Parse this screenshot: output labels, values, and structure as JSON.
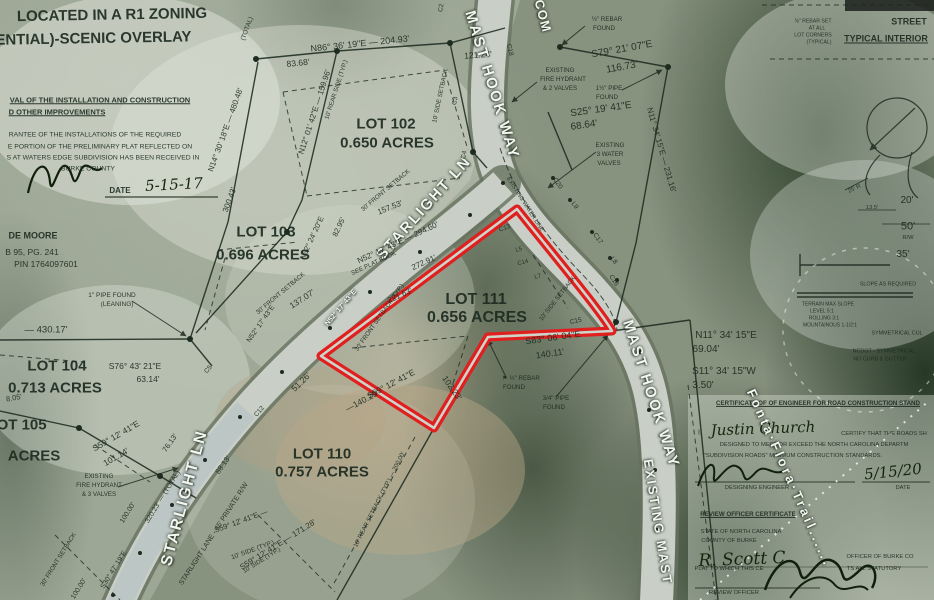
{
  "colors": {
    "highlight_outline": "#e01f1f",
    "ink": "#1d2b20",
    "street_label_white": "#f3f5ef",
    "handwriting": "#13260c",
    "road_fill": "#c9cfc6",
    "road_edge": "#66725f"
  },
  "labels": [
    {
      "n": "zoning-note-line1",
      "t": "LOCATED IN A R1 ZONING",
      "x": 112,
      "y": 15,
      "s": 15,
      "b": 1,
      "r": -1
    },
    {
      "n": "zoning-note-line2",
      "t": "(RESIDENTIAL)-SCENIC OVERLAY",
      "x": 68,
      "y": 39,
      "s": 15,
      "b": 1,
      "r": -1
    },
    {
      "t": "VAL OF THE INSTALLATION AND CONSTRUCTION",
      "x": 100,
      "y": 100,
      "s": 7.5,
      "b": 1,
      "u": 1
    },
    {
      "t": "D OTHER IMPROVEMENTS",
      "x": 57,
      "y": 112,
      "s": 7.5,
      "b": 1,
      "u": 1
    },
    {
      "t": "RANTEE OF THE INSTALLATIONS OF THE REQUIRED",
      "x": 95,
      "y": 136,
      "s": 6.8
    },
    {
      "t": "E PORTION OF THE PRELIMINARY PLAT REFLECTED ON",
      "x": 100,
      "y": 148,
      "s": 6.8
    },
    {
      "t": "S AT WATERS EDGE SUBDIVISION HAS BEEN RECEIVED IN",
      "x": 103,
      "y": 159,
      "s": 6.8
    },
    {
      "t": "BURKE COUNTY",
      "x": 88,
      "y": 170,
      "s": 6.8
    },
    {
      "t": "DATE",
      "x": 120,
      "y": 191,
      "s": 8,
      "b": 1
    },
    {
      "n": "approval-date-handwritten",
      "t": "5-15-17",
      "x": 174,
      "y": 185,
      "s": 15,
      "c": "hand",
      "r": -3
    },
    {
      "t": "DE MOORE",
      "x": 33,
      "y": 236,
      "s": 9,
      "b": 1
    },
    {
      "t": "B 95, PG. 241",
      "x": 32,
      "y": 252,
      "s": 8.5
    },
    {
      "t": "PIN 1764097601",
      "x": 46,
      "y": 264,
      "s": 8.5
    },
    {
      "t": "1\" PIPE FOUND",
      "x": 112,
      "y": 296,
      "s": 6.5
    },
    {
      "t": "(LEANING)",
      "x": 117,
      "y": 305,
      "s": 6.5
    },
    {
      "t": "— 430.17'",
      "x": 46,
      "y": 330,
      "s": 9.5
    },
    {
      "n": "lot-104-name",
      "t": "LOT 104",
      "x": 57,
      "y": 366,
      "s": 15,
      "b": 1
    },
    {
      "n": "lot-104-acreage",
      "t": "0.713 ACRES",
      "x": 55,
      "y": 388,
      "s": 15,
      "b": 1
    },
    {
      "t": "S76° 43' 21\"E",
      "x": 135,
      "y": 366,
      "s": 8.5
    },
    {
      "t": "63.14'",
      "x": 148,
      "y": 379,
      "s": 8.5
    },
    {
      "t": "8.05'",
      "x": 14,
      "y": 398,
      "s": 7.5,
      "r": -10
    },
    {
      "n": "lot-105-name",
      "t": "LOT 105",
      "x": 17,
      "y": 425,
      "s": 15,
      "b": 1
    },
    {
      "n": "lot-105-acreage",
      "t": "ACRES",
      "x": 34,
      "y": 456,
      "s": 15,
      "b": 1
    },
    {
      "t": "S59° 12' 41\"E",
      "x": 116,
      "y": 436,
      "r": -30,
      "s": 8.5
    },
    {
      "t": "101.14'",
      "x": 116,
      "y": 457,
      "r": -30,
      "s": 8.5
    },
    {
      "t": "EXISTING",
      "x": 99,
      "y": 477,
      "s": 6.2
    },
    {
      "t": "FIRE HYDRANT",
      "x": 99,
      "y": 486,
      "s": 6.2
    },
    {
      "t": "& 3 VALVES",
      "x": 99,
      "y": 495,
      "s": 6.2
    },
    {
      "t": "76.13'",
      "x": 170,
      "y": 443,
      "r": -55,
      "s": 7.5
    },
    {
      "n": "street-starlight-ln-lower",
      "t": "STARLIGHT LN",
      "x": 185,
      "y": 498,
      "r": -75,
      "s": 16,
      "c": "white",
      "sp": 2
    },
    {
      "t": "STARLIGHT LANE - 45' PRIVATE R/W",
      "x": 214,
      "y": 534,
      "r": -57,
      "s": 7
    },
    {
      "t": "320.23' — (TOTAL)",
      "x": 163,
      "y": 497,
      "r": -58,
      "s": 7
    },
    {
      "t": "100.00'",
      "x": 128,
      "y": 513,
      "r": -58,
      "s": 7
    },
    {
      "t": "S30° 47' 19\"E",
      "x": 114,
      "y": 570,
      "r": -58,
      "s": 7
    },
    {
      "t": "100.00'",
      "x": 79,
      "y": 589,
      "r": -58,
      "s": 7
    },
    {
      "t": "S59° 12' 41\"E —",
      "x": 241,
      "y": 521,
      "r": -20,
      "s": 7.5
    },
    {
      "t": "10' SIDE (TYP.)",
      "x": 253,
      "y": 551,
      "r": -20,
      "s": 6.5
    },
    {
      "t": "30' FRONT SETBACK",
      "x": 59,
      "y": 560,
      "r": -58,
      "s": 6.2
    },
    {
      "t": "88.13'",
      "x": 223,
      "y": 465,
      "r": -55,
      "s": 7.5
    },
    {
      "n": "lot-103-name",
      "t": "LOT 103",
      "x": 266,
      "y": 232,
      "s": 15,
      "b": 1
    },
    {
      "n": "lot-103-acreage",
      "t": "0.696 ACRES",
      "x": 263,
      "y": 255,
      "s": 15,
      "b": 1
    },
    {
      "t": "N32° 24' 20\"E",
      "x": 312,
      "y": 238,
      "r": -65,
      "s": 7.5
    },
    {
      "t": "82.95'",
      "x": 339,
      "y": 227,
      "r": -65,
      "s": 7.5
    },
    {
      "t": "30' FRONT SETBACK",
      "x": 281,
      "y": 294,
      "r": -40,
      "s": 6.2
    },
    {
      "t": "137.07'",
      "x": 302,
      "y": 299,
      "r": -33,
      "s": 8.5
    },
    {
      "t": "N52° 17' 43\"E",
      "x": 341,
      "y": 308,
      "r": -50,
      "s": 7,
      "c": "white"
    },
    {
      "t": "N52° 17' 43\"E",
      "x": 261,
      "y": 324,
      "r": -55,
      "s": 7
    },
    {
      "t": "C5",
      "x": 209,
      "y": 370,
      "r": -50,
      "s": 6.5
    },
    {
      "t": "C12",
      "x": 260,
      "y": 412,
      "r": -50,
      "s": 6.5
    },
    {
      "t": "51.26'",
      "x": 301,
      "y": 382,
      "r": -45,
      "s": 8.5
    },
    {
      "n": "street-starlight-ln-upper",
      "t": "STARLIGHT LN",
      "x": 424,
      "y": 208,
      "r": -48,
      "s": 15,
      "c": "white",
      "sp": 2
    },
    {
      "t": "N86° 36' 19\"E — 204.93'",
      "x": 360,
      "y": 44,
      "r": -6,
      "s": 9
    },
    {
      "t": "83.68'",
      "x": 298,
      "y": 63,
      "r": -6,
      "s": 8.5
    },
    {
      "t": "121.24'",
      "x": 478,
      "y": 55,
      "r": -4,
      "s": 8.5
    },
    {
      "t": "N12° 01' 42\"E — 159.96'",
      "x": 315,
      "y": 112,
      "r": -72,
      "s": 8
    },
    {
      "t": "10' REAR SIDE (TYP.)",
      "x": 337,
      "y": 90,
      "r": -72,
      "s": 6.2
    },
    {
      "n": "lot-102-name",
      "t": "LOT 102",
      "x": 386,
      "y": 124,
      "s": 15,
      "b": 1
    },
    {
      "n": "lot-102-acreage",
      "t": "0.650 ACRES",
      "x": 387,
      "y": 143,
      "s": 15,
      "b": 1
    },
    {
      "t": "10' SIDE SETBACK",
      "x": 441,
      "y": 96,
      "r": -78,
      "s": 6.2
    },
    {
      "t": "(TOTAL)",
      "x": 248,
      "y": 29,
      "r": -70,
      "s": 6.5
    },
    {
      "t": "N14° 30' 18\"E — 480.48'",
      "x": 226,
      "y": 130,
      "r": -70,
      "s": 8
    },
    {
      "t": "300.43'",
      "x": 230,
      "y": 200,
      "r": -70,
      "s": 8
    },
    {
      "t": "C2",
      "x": 442,
      "y": 8,
      "r": -80,
      "s": 6.5
    },
    {
      "t": "C3",
      "x": 456,
      "y": 101,
      "r": -80,
      "s": 6.5
    },
    {
      "t": "C4",
      "x": 465,
      "y": 155,
      "r": -80,
      "s": 6.5
    },
    {
      "t": "30' FRONT SETBACK",
      "x": 386,
      "y": 191,
      "r": -40,
      "s": 6.2
    },
    {
      "t": "SEE PLAT BOOK",
      "x": 374,
      "y": 264,
      "r": -25,
      "s": 6.2
    },
    {
      "t": "157.53'",
      "x": 390,
      "y": 208,
      "r": -22,
      "s": 8
    },
    {
      "t": "N52° 17' 43\"E — 294.60'",
      "x": 398,
      "y": 243,
      "r": -25,
      "s": 8
    },
    {
      "t": "272.91'",
      "x": 424,
      "y": 263,
      "r": -25,
      "s": 8
    },
    {
      "t": "221.63'",
      "x": 400,
      "y": 296,
      "r": -25,
      "s": 8
    },
    {
      "t": "30' FRONT SETBACK (TYP.)",
      "x": 380,
      "y": 318,
      "r": -55,
      "s": 6.2
    },
    {
      "n": "street-mast-hook-way-upper",
      "t": "MAST HOOK WAY",
      "x": 492,
      "y": 85,
      "r": 73,
      "s": 15,
      "c": "white",
      "sp": 2
    },
    {
      "n": "street-common-area",
      "t": "COM",
      "x": 543,
      "y": 16,
      "r": 75,
      "s": 13,
      "c": "white",
      "sp": 1
    },
    {
      "t": "½\" REBAR",
      "x": 607,
      "y": 20,
      "s": 6.2
    },
    {
      "t": "FOUND",
      "x": 604,
      "y": 29,
      "s": 6.2
    },
    {
      "t": "S79° 21' 07\"E",
      "x": 622,
      "y": 50,
      "r": -10,
      "s": 10
    },
    {
      "t": "116.73'",
      "x": 622,
      "y": 68,
      "r": -10,
      "s": 10
    },
    {
      "t": "EXISTING",
      "x": 560,
      "y": 71,
      "s": 6.2
    },
    {
      "t": "FIRE HYDRANT",
      "x": 563,
      "y": 80,
      "s": 6.2
    },
    {
      "t": "& 2 VALVES",
      "x": 560,
      "y": 89,
      "s": 6.2
    },
    {
      "t": "1½\" PIPE",
      "x": 609,
      "y": 89,
      "s": 6.2
    },
    {
      "t": "FOUND",
      "x": 607,
      "y": 98,
      "s": 6.2
    },
    {
      "t": "S25° 19' 41\"E",
      "x": 601,
      "y": 110,
      "r": -8,
      "s": 10
    },
    {
      "t": "68.64'",
      "x": 584,
      "y": 126,
      "r": -8,
      "s": 10
    },
    {
      "t": "EXISTING",
      "x": 610,
      "y": 146,
      "s": 6.2
    },
    {
      "t": "3 WATER",
      "x": 610,
      "y": 155,
      "s": 6.2
    },
    {
      "t": "VALVES",
      "x": 609,
      "y": 164,
      "s": 6.2
    },
    {
      "t": "N11° 34' 15\"E — 231.16'",
      "x": 661,
      "y": 150,
      "r": 74,
      "s": 8
    },
    {
      "t": "C18",
      "x": 509,
      "y": 50,
      "r": 78,
      "s": 6.5
    },
    {
      "t": "C20",
      "x": 557,
      "y": 184,
      "r": 55,
      "s": 6.5
    },
    {
      "t": "L9",
      "x": 574,
      "y": 206,
      "r": 55,
      "s": 6.5
    },
    {
      "t": "C17",
      "x": 597,
      "y": 239,
      "r": 55,
      "s": 6.5
    },
    {
      "t": "L8",
      "x": 613,
      "y": 261,
      "r": 55,
      "s": 6.5
    },
    {
      "t": "C16",
      "x": 613,
      "y": 281,
      "r": 55,
      "s": 6.5
    },
    {
      "t": "EXISTING WATER LINE",
      "x": 524,
      "y": 205,
      "r": 57,
      "s": 5.8
    },
    {
      "t": "C13",
      "x": 505,
      "y": 229,
      "r": -20,
      "s": 6.5
    },
    {
      "t": "L5",
      "x": 519,
      "y": 250,
      "r": -15,
      "s": 6
    },
    {
      "t": "C14",
      "x": 523,
      "y": 263,
      "r": -15,
      "s": 6
    },
    {
      "t": "L7",
      "x": 538,
      "y": 277,
      "r": -15,
      "s": 6
    },
    {
      "t": "C15",
      "x": 576,
      "y": 322,
      "r": -12,
      "s": 6.5
    },
    {
      "t": "10' SIDE SETBACK",
      "x": 558,
      "y": 299,
      "r": -52,
      "s": 6.2
    },
    {
      "n": "lot-111-name",
      "t": "LOT 111",
      "x": 476,
      "y": 300,
      "s": 16,
      "b": 1
    },
    {
      "n": "lot-111-acreage",
      "t": "0.656 ACRES",
      "x": 477,
      "y": 318,
      "s": 16,
      "b": 1
    },
    {
      "t": "S83° 06' 04\"E",
      "x": 553,
      "y": 338,
      "r": -8,
      "s": 9
    },
    {
      "t": "140.11'",
      "x": 550,
      "y": 354,
      "r": -8,
      "s": 9
    },
    {
      "t": "⚑ ½\" REBAR",
      "x": 521,
      "y": 379,
      "s": 6.2
    },
    {
      "t": "FOUND",
      "x": 514,
      "y": 388,
      "s": 6.2
    },
    {
      "t": "3/4\" PIPE",
      "x": 556,
      "y": 399,
      "s": 6.2
    },
    {
      "t": "FOUND",
      "x": 554,
      "y": 408,
      "s": 6.2
    },
    {
      "t": "S59° 12' 41\"E",
      "x": 391,
      "y": 384,
      "r": -28,
      "s": 8.5
    },
    {
      "t": "—140.29'",
      "x": 362,
      "y": 401,
      "r": -28,
      "s": 8.5
    },
    {
      "t": "102.23'",
      "x": 452,
      "y": 388,
      "r": 55,
      "s": 8.5
    },
    {
      "t": "N11° 34' 15\"E",
      "x": 726,
      "y": 336,
      "s": 10
    },
    {
      "t": "69.04'",
      "x": 706,
      "y": 350,
      "s": 10
    },
    {
      "t": "S11° 34' 15\"W",
      "x": 724,
      "y": 372,
      "s": 10
    },
    {
      "t": "3.50'",
      "x": 703,
      "y": 386,
      "s": 10
    },
    {
      "n": "street-mast-hook-way-lower",
      "t": "MAST HOOK WAY",
      "x": 651,
      "y": 394,
      "r": 72,
      "s": 15,
      "c": "white",
      "sp": 2
    },
    {
      "n": "street-existing-mast",
      "t": "EXISTING MAST",
      "x": 658,
      "y": 522,
      "r": 81,
      "s": 13,
      "c": "white",
      "sp": 2
    },
    {
      "n": "lot-110-name",
      "t": "LOT 110",
      "x": 322,
      "y": 454,
      "s": 15,
      "b": 1
    },
    {
      "n": "lot-110-acreage",
      "t": "0.757 ACRES",
      "x": 322,
      "y": 472,
      "s": 15,
      "b": 1
    },
    {
      "t": "10' REAR SETBACK (TYP.) — 200.00'",
      "x": 380,
      "y": 500,
      "r": -63,
      "s": 6.2
    },
    {
      "t": "S59° 12' 41\"E — 171.28'",
      "x": 278,
      "y": 545,
      "r": -32,
      "s": 8
    },
    {
      "t": "10' SIDE (TYP.)",
      "x": 262,
      "y": 561,
      "r": -32,
      "s": 6.2
    },
    {
      "t": "⅝\" REBAR SET",
      "x": 813,
      "y": 22,
      "s": 5.2
    },
    {
      "t": "AT ALL",
      "x": 817,
      "y": 29,
      "s": 5.2
    },
    {
      "t": "LOT CORNERS",
      "x": 813,
      "y": 36,
      "s": 5.2
    },
    {
      "t": "(TYPICAL)",
      "x": 819,
      "y": 43,
      "s": 5.2
    },
    {
      "n": "street-typical-title1",
      "t": "STREET",
      "x": 909,
      "y": 22,
      "s": 9,
      "b": 1
    },
    {
      "n": "street-typical-title2",
      "t": "TYPICAL INTERIOR",
      "x": 886,
      "y": 39,
      "s": 9,
      "b": 1,
      "u": 1
    },
    {
      "t": "25' R",
      "x": 855,
      "y": 190,
      "r": -25,
      "s": 5.8
    },
    {
      "t": "13.5'",
      "x": 872,
      "y": 209,
      "s": 5.8
    },
    {
      "t": "20'",
      "x": 907,
      "y": 201,
      "s": 10
    },
    {
      "t": "50'",
      "x": 908,
      "y": 227,
      "s": 11
    },
    {
      "t": "R/W",
      "x": 908,
      "y": 239,
      "s": 5.8
    },
    {
      "t": "35'",
      "x": 903,
      "y": 255,
      "s": 10
    },
    {
      "t": "SLOPE AS REQUIRED",
      "x": 888,
      "y": 285,
      "s": 5.4
    },
    {
      "t": "TERRAIN    MAX SLOPE",
      "x": 828,
      "y": 305,
      "s": 5
    },
    {
      "t": "LEVEL              5:1",
      "x": 822,
      "y": 312,
      "s": 5
    },
    {
      "t": "ROLLING          3:1",
      "x": 824,
      "y": 319,
      "s": 5
    },
    {
      "t": "MOUNTAINOUS   1-1/2:1",
      "x": 830,
      "y": 326,
      "s": 5
    },
    {
      "t": "SYMMETRICAL CUL",
      "x": 897,
      "y": 334,
      "s": 5.4
    },
    {
      "t": "NCDOT - SYMMETRICAL",
      "x": 884,
      "y": 352,
      "s": 5.4
    },
    {
      "t": "NO CURB & GUTTER",
      "x": 880,
      "y": 360,
      "s": 5.4
    },
    {
      "n": "engineer-cert-title",
      "t": "CERTIFICATE OF OF ENGINEER FOR ROAD CONSTRUCTION STAND",
      "x": 818,
      "y": 404,
      "s": 6.2,
      "b": 1,
      "u": 1
    },
    {
      "t": "I,",
      "x": 700,
      "y": 433,
      "s": 7
    },
    {
      "n": "engineer-name-handwritten",
      "t": "Justin Church",
      "x": 763,
      "y": 429,
      "s": 15,
      "c": "hand",
      "r": -2
    },
    {
      "t": "CERTIFY THAT THE ROADS SH",
      "x": 884,
      "y": 435,
      "s": 5.8
    },
    {
      "t": "DESIGNED TO MEET OR EXCEED THE NORTH CAROLINA DEPARTM",
      "x": 814,
      "y": 446,
      "s": 5.8
    },
    {
      "t": "\"SUBDIVISION ROADS\" MINIMUM CONSTRUCTION STANDARDS.",
      "x": 793,
      "y": 457,
      "s": 5.8
    },
    {
      "n": "engineer-date-handwritten",
      "t": "5/15/20",
      "x": 893,
      "y": 472,
      "s": 15,
      "c": "hand",
      "r": -6
    },
    {
      "t": "DESIGNING ENGINEER",
      "x": 757,
      "y": 489,
      "s": 5.8
    },
    {
      "t": "DATE",
      "x": 903,
      "y": 489,
      "s": 5.8
    },
    {
      "n": "review-cert-title",
      "t": "REVIEW OFFICER CERTIFICATE",
      "x": 748,
      "y": 515,
      "s": 6.2,
      "b": 1,
      "u": 1
    },
    {
      "t": "STATE OF NORTH CAROLINA",
      "x": 741,
      "y": 533,
      "s": 5.8
    },
    {
      "t": "COUNTY OF BURKE",
      "x": 729,
      "y": 542,
      "s": 5.8
    },
    {
      "n": "review-officer-name-handwritten",
      "t": "R. Scott C",
      "x": 742,
      "y": 560,
      "s": 17,
      "c": "hand",
      "r": -2
    },
    {
      "t": "OFFICER OF BURKE CO",
      "x": 880,
      "y": 558,
      "s": 5.8
    },
    {
      "t": "PLAT TO WHICH THIS CE",
      "x": 729,
      "y": 570,
      "s": 5.8
    },
    {
      "t": "TS ALL STATUTORY",
      "x": 874,
      "y": 570,
      "s": 5.8
    },
    {
      "t": "REVIEW OFFICER",
      "x": 734,
      "y": 594,
      "s": 5.8
    },
    {
      "n": "watermark-trail",
      "t": "Fonta·Flora·Trail......",
      "x": 790,
      "y": 478,
      "r": 66,
      "s": 13,
      "c": "white",
      "sp": 3
    }
  ]
}
